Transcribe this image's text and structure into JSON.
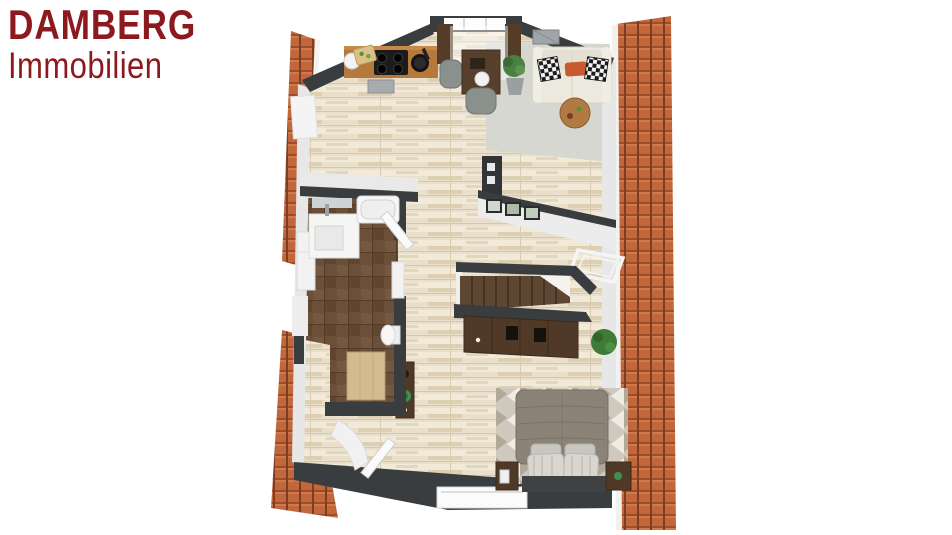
{
  "page": {
    "width": 952,
    "height": 535,
    "background": "#ffffff"
  },
  "logo": {
    "line1": "DAMBERG",
    "line2": "Immobilien",
    "color": "#8c191e"
  },
  "floor_plan": {
    "description": "3D top-down rendering of an attic apartment floor plan flanked by terracotta roof tile strips",
    "colors": {
      "roof_tiles": "#c2673c",
      "roof_tile_gap": "#7e3d22",
      "wall_dark": "#3a3d40",
      "wall_light": "#e9e9ea",
      "floor_wood": "#eadfca",
      "bathroom_tile": "#6b4f38",
      "rug": "#d5d7d0",
      "furniture_dark_wood": "#503a27",
      "counter_wood": "#b6793c",
      "sofa": "#ece9df",
      "bed_duvet": "#8b8278",
      "accent_orange": "#c85a32",
      "plant_green": "#4a8040"
    },
    "rooms": [
      {
        "name": "kitchen",
        "furniture": [
          "kitchen-counter",
          "cooktop",
          "sink",
          "frying-pan",
          "cutting-board",
          "oven"
        ]
      },
      {
        "name": "dining-area",
        "furniture": [
          "dining-table",
          "dining-chair",
          "dining-chair",
          "potted-plant",
          "window-curtains"
        ]
      },
      {
        "name": "living-area",
        "furniture": [
          "sofa",
          "throw-pillows",
          "coffee-table",
          "area-rug",
          "potted-plant",
          "wall-vent"
        ]
      },
      {
        "name": "bathroom",
        "furniture": [
          "vanity-sink",
          "mirror",
          "bathtub",
          "toilet",
          "shelf",
          "dresser",
          "washer",
          "door"
        ]
      },
      {
        "name": "hallway",
        "furniture": [
          "framed-pictures",
          "skylight-window",
          "console-table",
          "plant",
          "door"
        ]
      },
      {
        "name": "staircase",
        "furniture": [
          "stairs",
          "sideboard",
          "shoes"
        ]
      },
      {
        "name": "bedroom",
        "furniture": [
          "double-bed",
          "pillows",
          "headboard",
          "nightstand",
          "nightstand",
          "chevron-rug"
        ]
      }
    ]
  }
}
